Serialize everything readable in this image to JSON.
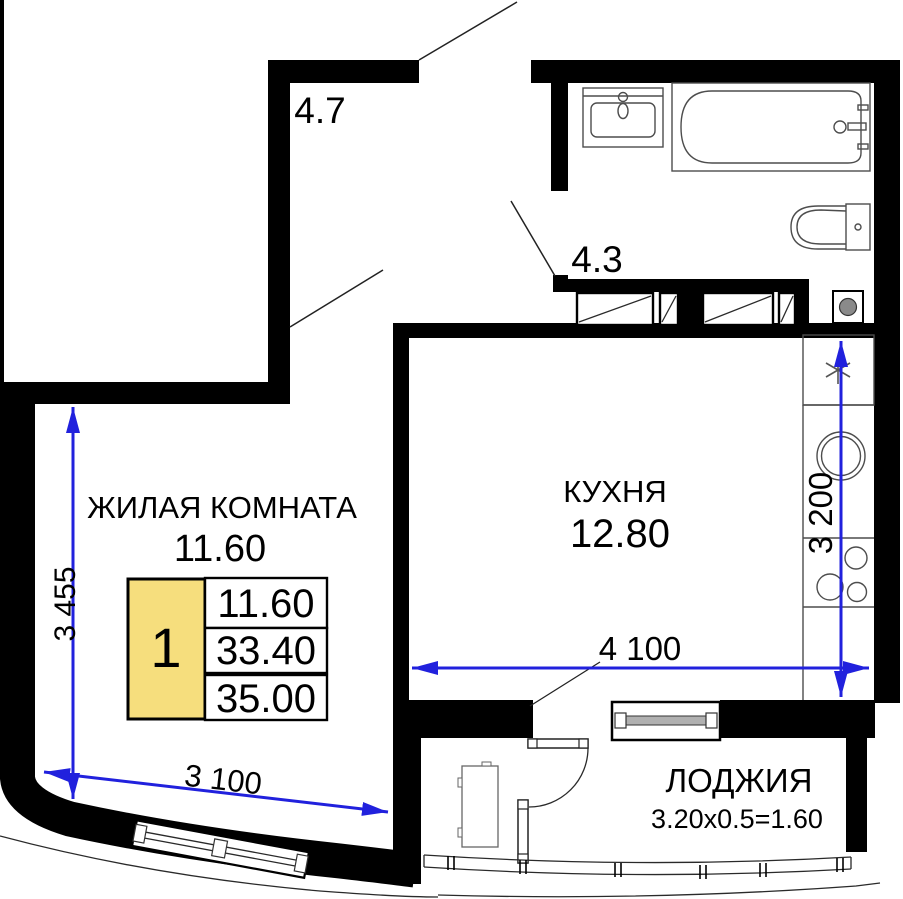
{
  "plan": {
    "title": "apartment-floor-plan",
    "rooms": {
      "hallway": {
        "area": "4.7"
      },
      "bathroom": {
        "area": "4.3"
      },
      "living_room": {
        "name": "ЖИЛАЯ КОМНАТА",
        "area": "11.60"
      },
      "kitchen": {
        "name": "КУХНЯ",
        "area": "12.80"
      },
      "loggia": {
        "name": "ЛОДЖИЯ",
        "area_formula": "3.20x0.5=1.60"
      }
    },
    "dimensions": {
      "living_room_width": "3 100",
      "living_room_height": "3 455",
      "kitchen_width": "4 100",
      "kitchen_height": "3 200"
    },
    "info_table": {
      "unit_number": "1",
      "rows": {
        "living_area": "11.60",
        "area_without_loggia": "33.40",
        "total_area": "35.00"
      }
    },
    "fixtures": [
      "bathtub",
      "wash-basin",
      "toilet",
      "washing-machine",
      "fridge-snowflake-symbol",
      "kitchen-sink",
      "stove-burners",
      "radiator-window",
      "loggia-door",
      "loggia-cabinet",
      "balcony-glazing"
    ],
    "colors": {
      "dimension_blue": "#2121dd",
      "table_yellow": "#f6de7d",
      "wall_black": "#000000",
      "background": "#ffffff"
    }
  }
}
